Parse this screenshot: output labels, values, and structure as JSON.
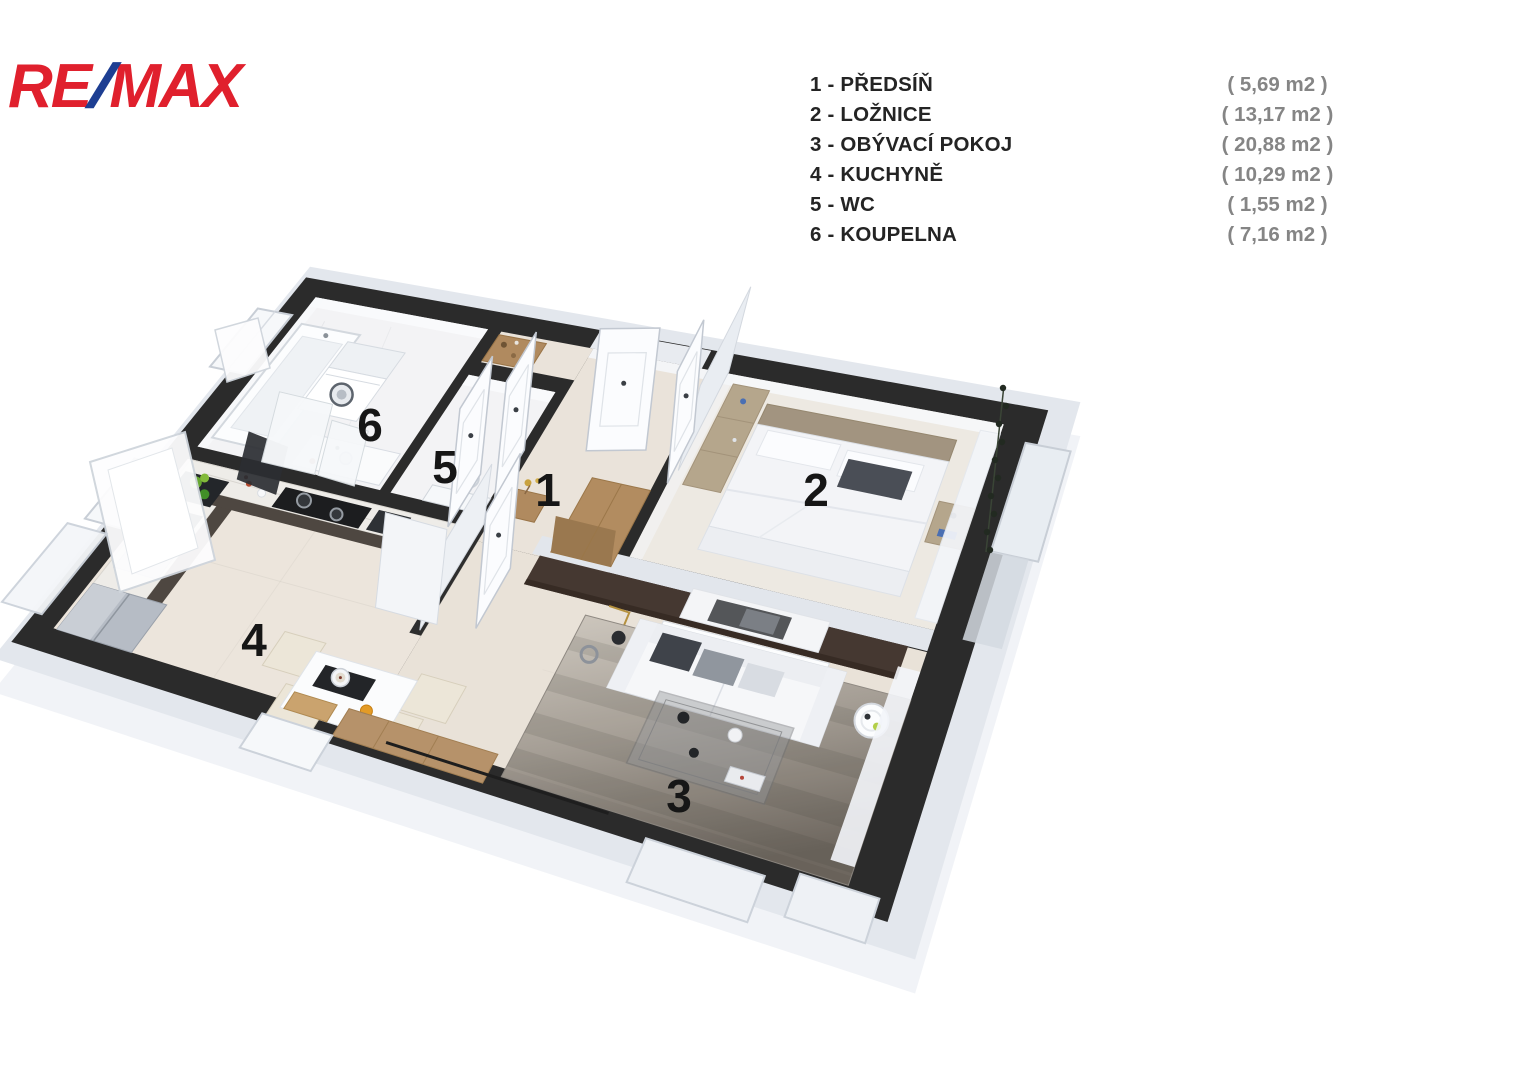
{
  "brand": {
    "logo_re": "RE",
    "logo_slash": "/",
    "logo_max": "MAX",
    "red": "#e0202d",
    "blue": "#1d3e92"
  },
  "legend": {
    "name_color": "#242424",
    "area_color": "#858585",
    "items": [
      {
        "label": "1 - PŘEDSÍŇ",
        "area": "( 5,69 m2 )"
      },
      {
        "label": "2 - LOŽNICE",
        "area": "( 13,17 m2 )"
      },
      {
        "label": "3 - OBÝVACÍ POKOJ",
        "area": "( 20,88 m2 )"
      },
      {
        "label": "4 - KUCHYNĚ",
        "area": "( 10,29 m2 )"
      },
      {
        "label": "5 - WC",
        "area": "( 1,55 m2 )"
      },
      {
        "label": "6 - KOUPELNA",
        "area": "( 7,16 m2 )"
      }
    ]
  },
  "floorplan": {
    "room_labels": [
      {
        "num": "1",
        "x": 548,
        "y": 490
      },
      {
        "num": "2",
        "x": 816,
        "y": 490
      },
      {
        "num": "3",
        "x": 679,
        "y": 796
      },
      {
        "num": "4",
        "x": 254,
        "y": 640
      },
      {
        "num": "5",
        "x": 445,
        "y": 467
      },
      {
        "num": "6",
        "x": 370,
        "y": 425
      }
    ],
    "colors": {
      "wall": "#2b2b2b",
      "marble_floor": "#f3f3f5",
      "kitchen_floor": "#ece5dc",
      "hall_floor": "#eae3da",
      "bedroom_floor": "#ede9e2",
      "living_floor": "#e9e2d8",
      "accent_wall": "#453831",
      "wood": "#b08a5f",
      "cabinet": "#4e4741",
      "slab": "#e3e7ed",
      "slab_side": "#f1f3f7",
      "rug_light": "#cfc9c0",
      "rug_dark": "#6b645c"
    }
  }
}
